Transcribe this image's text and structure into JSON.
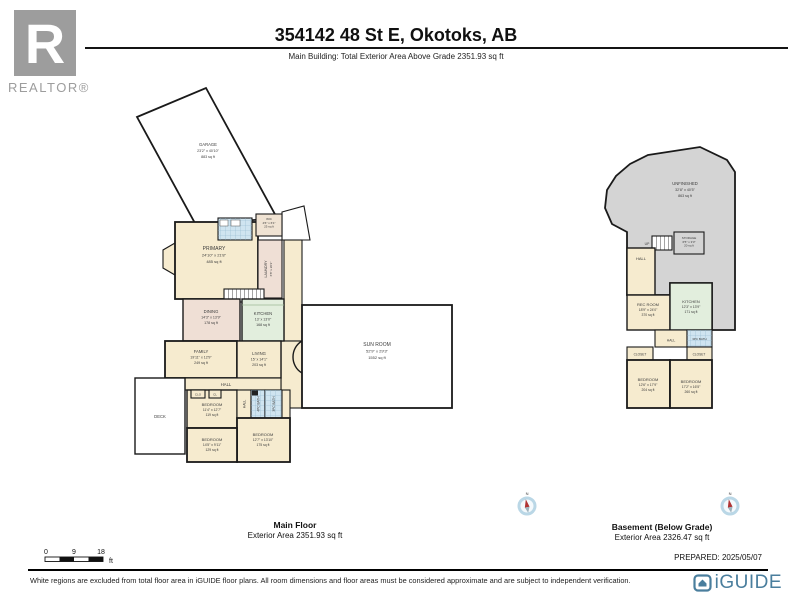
{
  "colors": {
    "wall": "#1a1a1a",
    "room_cream": "#f6ebcf",
    "room_pink": "#efdfd5",
    "room_green": "#e2eedd",
    "bath_blue": "#cfe4f0",
    "unfinished_gray": "#d4d4d4",
    "brand_blue": "#4a7e9d",
    "realtor_gray": "#9d9d9d",
    "compass_red": "#b03434"
  },
  "header": {
    "title": "354142 48 St E, Okotoks, AB",
    "subtitle": "Main Building: Total Exterior Area Above Grade 2351.93 sq ft"
  },
  "realtor": {
    "letter": "R",
    "wordmark": "REALTOR®"
  },
  "main_floor": {
    "title": "Main Floor",
    "area": "Exterior Area 2351.93 sq ft",
    "rooms": {
      "garage": {
        "name": "GARAGE",
        "dims": "23'2\" x 40'10\"",
        "area": "883 sq ft"
      },
      "primary": {
        "name": "PRIMARY",
        "dims": "24'10\" x 21'8\"",
        "area": "485 sq ft"
      },
      "wic": {
        "name": "WIC",
        "dims": "4'6\" x 6'1\"",
        "area": "25 sq ft"
      },
      "laundry": {
        "name": "LAUNDRY",
        "dims": "6'8\" x 20'2\""
      },
      "dining": {
        "name": "DINING",
        "dims": "14'3\" x 13'9\"",
        "area": "178 sq ft"
      },
      "kitchen": {
        "name": "KITCHEN",
        "dims": "13' x 13'0\"",
        "area": "168 sq ft"
      },
      "family": {
        "name": "FAMILY",
        "dims": "19'11\" x 12'9\"",
        "area": "249 sq ft"
      },
      "living": {
        "name": "LIVING",
        "dims": "15' x 14'1\"",
        "area": "203 sq ft"
      },
      "sunroom": {
        "name": "SUN ROOM",
        "dims": "52'9\" x 29'3\"",
        "area": "1552 sq ft"
      },
      "hall": {
        "name": "HALL"
      },
      "hall2": {
        "name": "HALL"
      },
      "deck": {
        "name": "DECK"
      },
      "closet": {
        "name": "CLO"
      },
      "closet2": {
        "name": "CL"
      },
      "bedroom_center": {
        "name": "BEDROOM",
        "dims": "11'4\" x 12'7\"",
        "area": "119 sq ft"
      },
      "bath4": {
        "name": "4PC BATH"
      },
      "bath3": {
        "name": "3PC BATH"
      },
      "bedroom_left": {
        "name": "BEDROOM",
        "dims": "14'5\" x 9'11\"",
        "area": "129 sq ft"
      },
      "bedroom_right": {
        "name": "BEDROOM",
        "dims": "12'7\" x 13'10\"",
        "area": "175 sq ft"
      }
    }
  },
  "basement": {
    "title": "Basement (Below Grade)",
    "area": "Exterior Area 2326.47 sq ft",
    "rooms": {
      "unfinished": {
        "name": "UNFINISHED",
        "dims": "32'8\" x 40'5\"",
        "area": "863 sq ft"
      },
      "up": {
        "name": "UP"
      },
      "storage": {
        "name": "STORAGE",
        "dims": "6'5\" x 3'3\"",
        "area": "20 sq ft"
      },
      "hall": {
        "name": "HALL"
      },
      "hall2": {
        "name": "HALL"
      },
      "recroom": {
        "name": "REC ROOM",
        "dims": "18'9\" x 24'0\"",
        "area": "370 sq ft"
      },
      "kitchen": {
        "name": "KITCHEN",
        "dims": "12'3\" x 13'9\"",
        "area": "171 sq ft"
      },
      "bath": {
        "name": "3PC BATH"
      },
      "closet_left": {
        "name": "CLOSET"
      },
      "closet_right": {
        "name": "CLOSET"
      },
      "bedroom_left": {
        "name": "BEDROOM",
        "dims": "12'6\" x 17'9\"",
        "area": "204 sq ft"
      },
      "bedroom_right": {
        "name": "BEDROOM",
        "dims": "17'2\" x 16'5\"",
        "area": "260 sq ft"
      }
    }
  },
  "scale_bar": {
    "t0": "0",
    "t9": "9",
    "t18": "18",
    "unit": "ft"
  },
  "compass": {
    "north": "N"
  },
  "prepared": "PREPARED: 2025/05/07",
  "footer": {
    "disclaimer": "White regions are excluded from total floor area in iGUIDE floor plans. All room dimensions and floor areas must be considered approximate and are subject to independent verification.",
    "brand": "iGUIDE"
  }
}
